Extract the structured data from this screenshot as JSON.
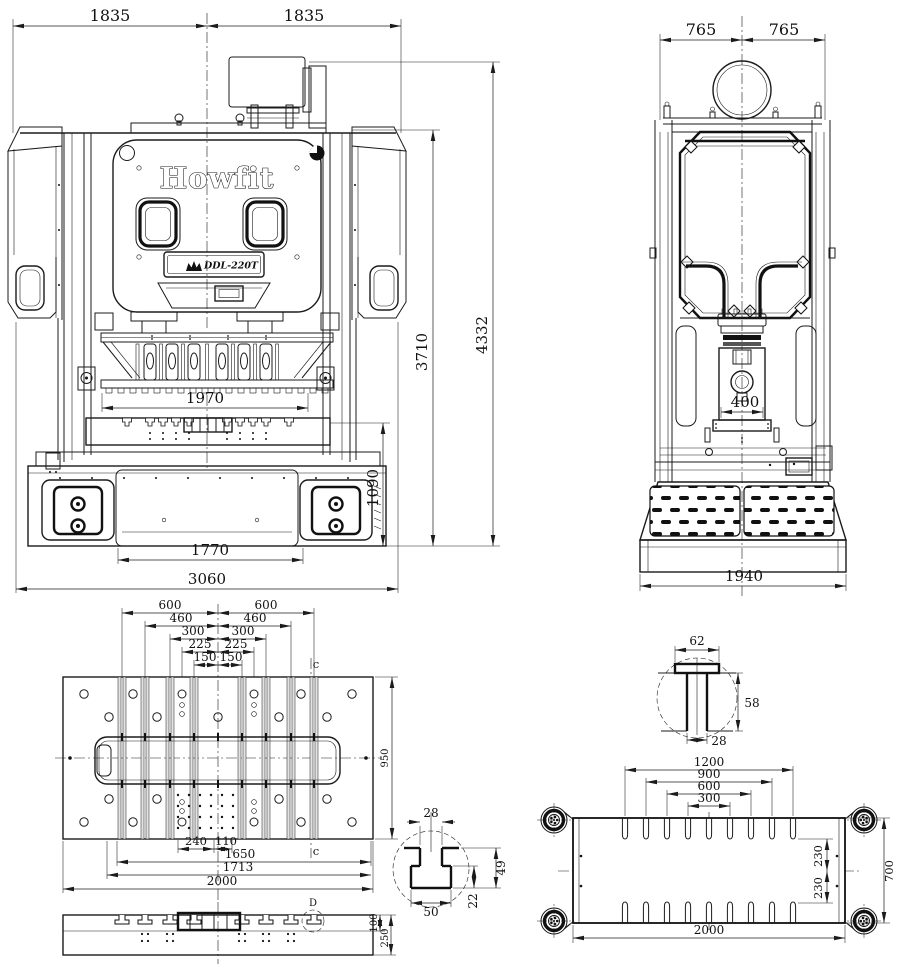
{
  "drawing": {
    "brand": "Howfit",
    "model": "DDL-220T"
  },
  "front_view": {
    "half_width_left": "1835",
    "half_width_right": "1835",
    "overall_height": "4332",
    "frame_height": "3710",
    "bed_height": "1090",
    "window_width": "1970",
    "base_inner_width": "1770",
    "overall_width": "3060"
  },
  "side_view": {
    "half_depth_left": "765",
    "half_depth_right": "765",
    "slide_width": "400",
    "base_depth": "1940"
  },
  "bolster_plan": {
    "slot_600_left": "600",
    "slot_600_right": "600",
    "slot_460_left": "460",
    "slot_460_right": "460",
    "slot_300_left": "300",
    "slot_300_right": "300",
    "slot_225_left": "225",
    "slot_225_right": "225",
    "slot_150_left": "150",
    "slot_150_right": "150",
    "hole_span_240": "240",
    "hole_span_110": "110",
    "span_1650": "1650",
    "span_1713": "1713",
    "plate_width": "2000",
    "plate_depth": "950",
    "section_mark_top": "c",
    "section_mark_bottom": "c"
  },
  "bolster_section": {
    "upper_thickness": "100",
    "total_thickness": "250",
    "detail_mark": "D"
  },
  "tenon_detail": {
    "top_width": "62",
    "height": "58",
    "stem_width": "28"
  },
  "tslot_detail": {
    "slot_width": "28",
    "bottom_width": "50",
    "depth": "49",
    "flange_depth": "22"
  },
  "slide_plan": {
    "slot_span_1200": "1200",
    "slot_span_900": "900",
    "slot_span_600": "600",
    "slot_span_300": "300",
    "offset_230_top": "230",
    "offset_230_bottom": "230",
    "plate_depth": "700",
    "plate_width": "2000"
  }
}
